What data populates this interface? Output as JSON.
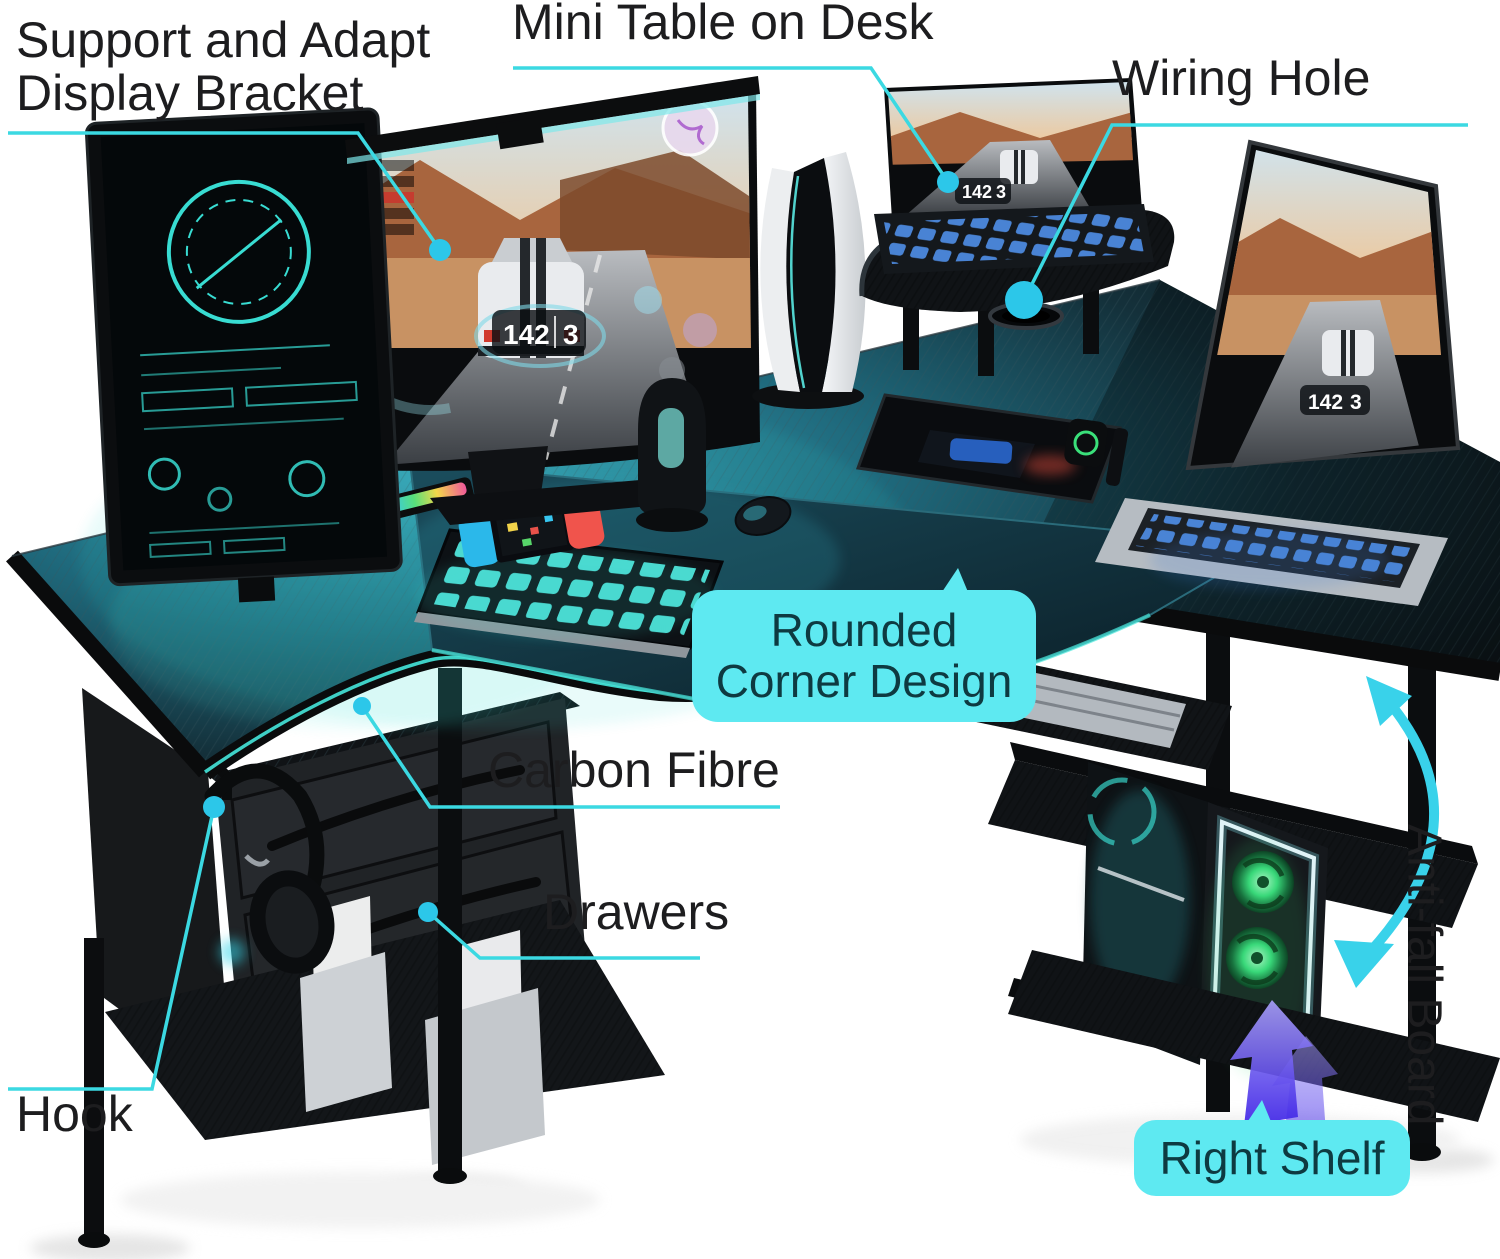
{
  "labels": {
    "display_bracket": "Support and Adapt\nDisplay Bracket",
    "mini_table": "Mini Table on Desk",
    "wiring_hole": "Wiring Hole",
    "rounded_corner": "Rounded\nCorner Design",
    "carbon_fibre": "Carbon Fibre",
    "drawers": "Drawers",
    "hook": "Hook",
    "right_shelf": "Right Shelf",
    "anti_fall": "Anti-fall Board"
  },
  "screen_hud": {
    "speed": "142",
    "gear": "3",
    "position": "3"
  },
  "colors": {
    "label_text": "#1d1d1f",
    "callout_bg": "#5ee9f1",
    "callout_text": "#0e3a41",
    "leader_line": "#3bd9e2",
    "leader_dot": "#2cc7e9",
    "desk_teal_glow": "#2f93a8",
    "purple_arrow": "#4a2ef0",
    "fan_green": "#46f08a"
  },
  "scene": {
    "objects": [
      "portrait-monitor",
      "curved-gaming-monitor",
      "monitor-light-bar",
      "game-console",
      "mini-table-riser",
      "tablet-with-keyboard",
      "wiring-grommet",
      "laptop",
      "rgb-mousepad",
      "gaming-keyboard",
      "mouse",
      "handheld-console",
      "rgb-light-bars",
      "tablet",
      "smartwatch",
      "drawer-pedestal",
      "headphones-on-hook",
      "file-organizers",
      "bottom-shelf",
      "keyboard-tray",
      "pc-tower",
      "right-shelf",
      "anti-fall-boards"
    ]
  }
}
